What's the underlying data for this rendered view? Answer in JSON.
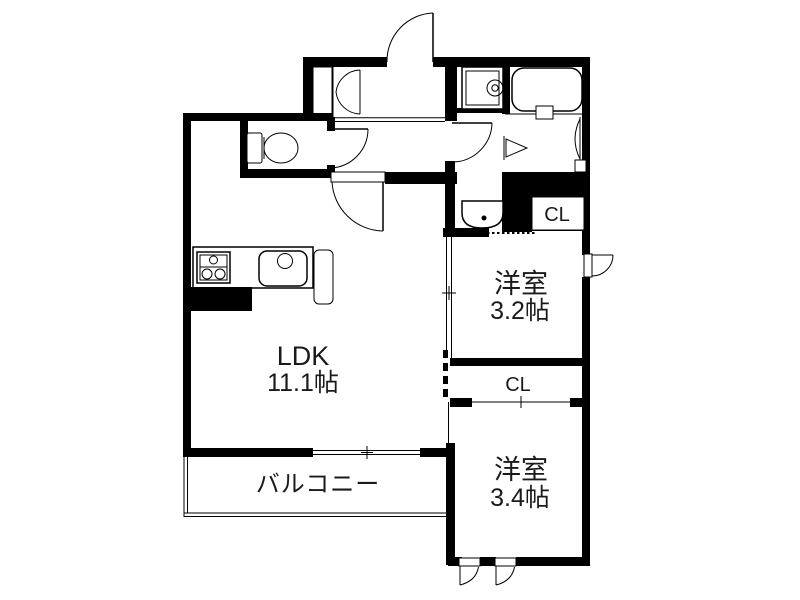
{
  "plan": {
    "labels": {
      "ldk": "LDK",
      "ldk_size": "11.1帖",
      "bedroom1": "洋室",
      "bedroom1_size": "3.2帖",
      "bedroom2": "洋室",
      "bedroom2_size": "3.4帖",
      "balcony": "バルコニー",
      "closet1": "CL",
      "closet2": "CL"
    },
    "colors": {
      "wall": "#000000",
      "background": "#ffffff",
      "text": "#1a1a1a"
    }
  }
}
